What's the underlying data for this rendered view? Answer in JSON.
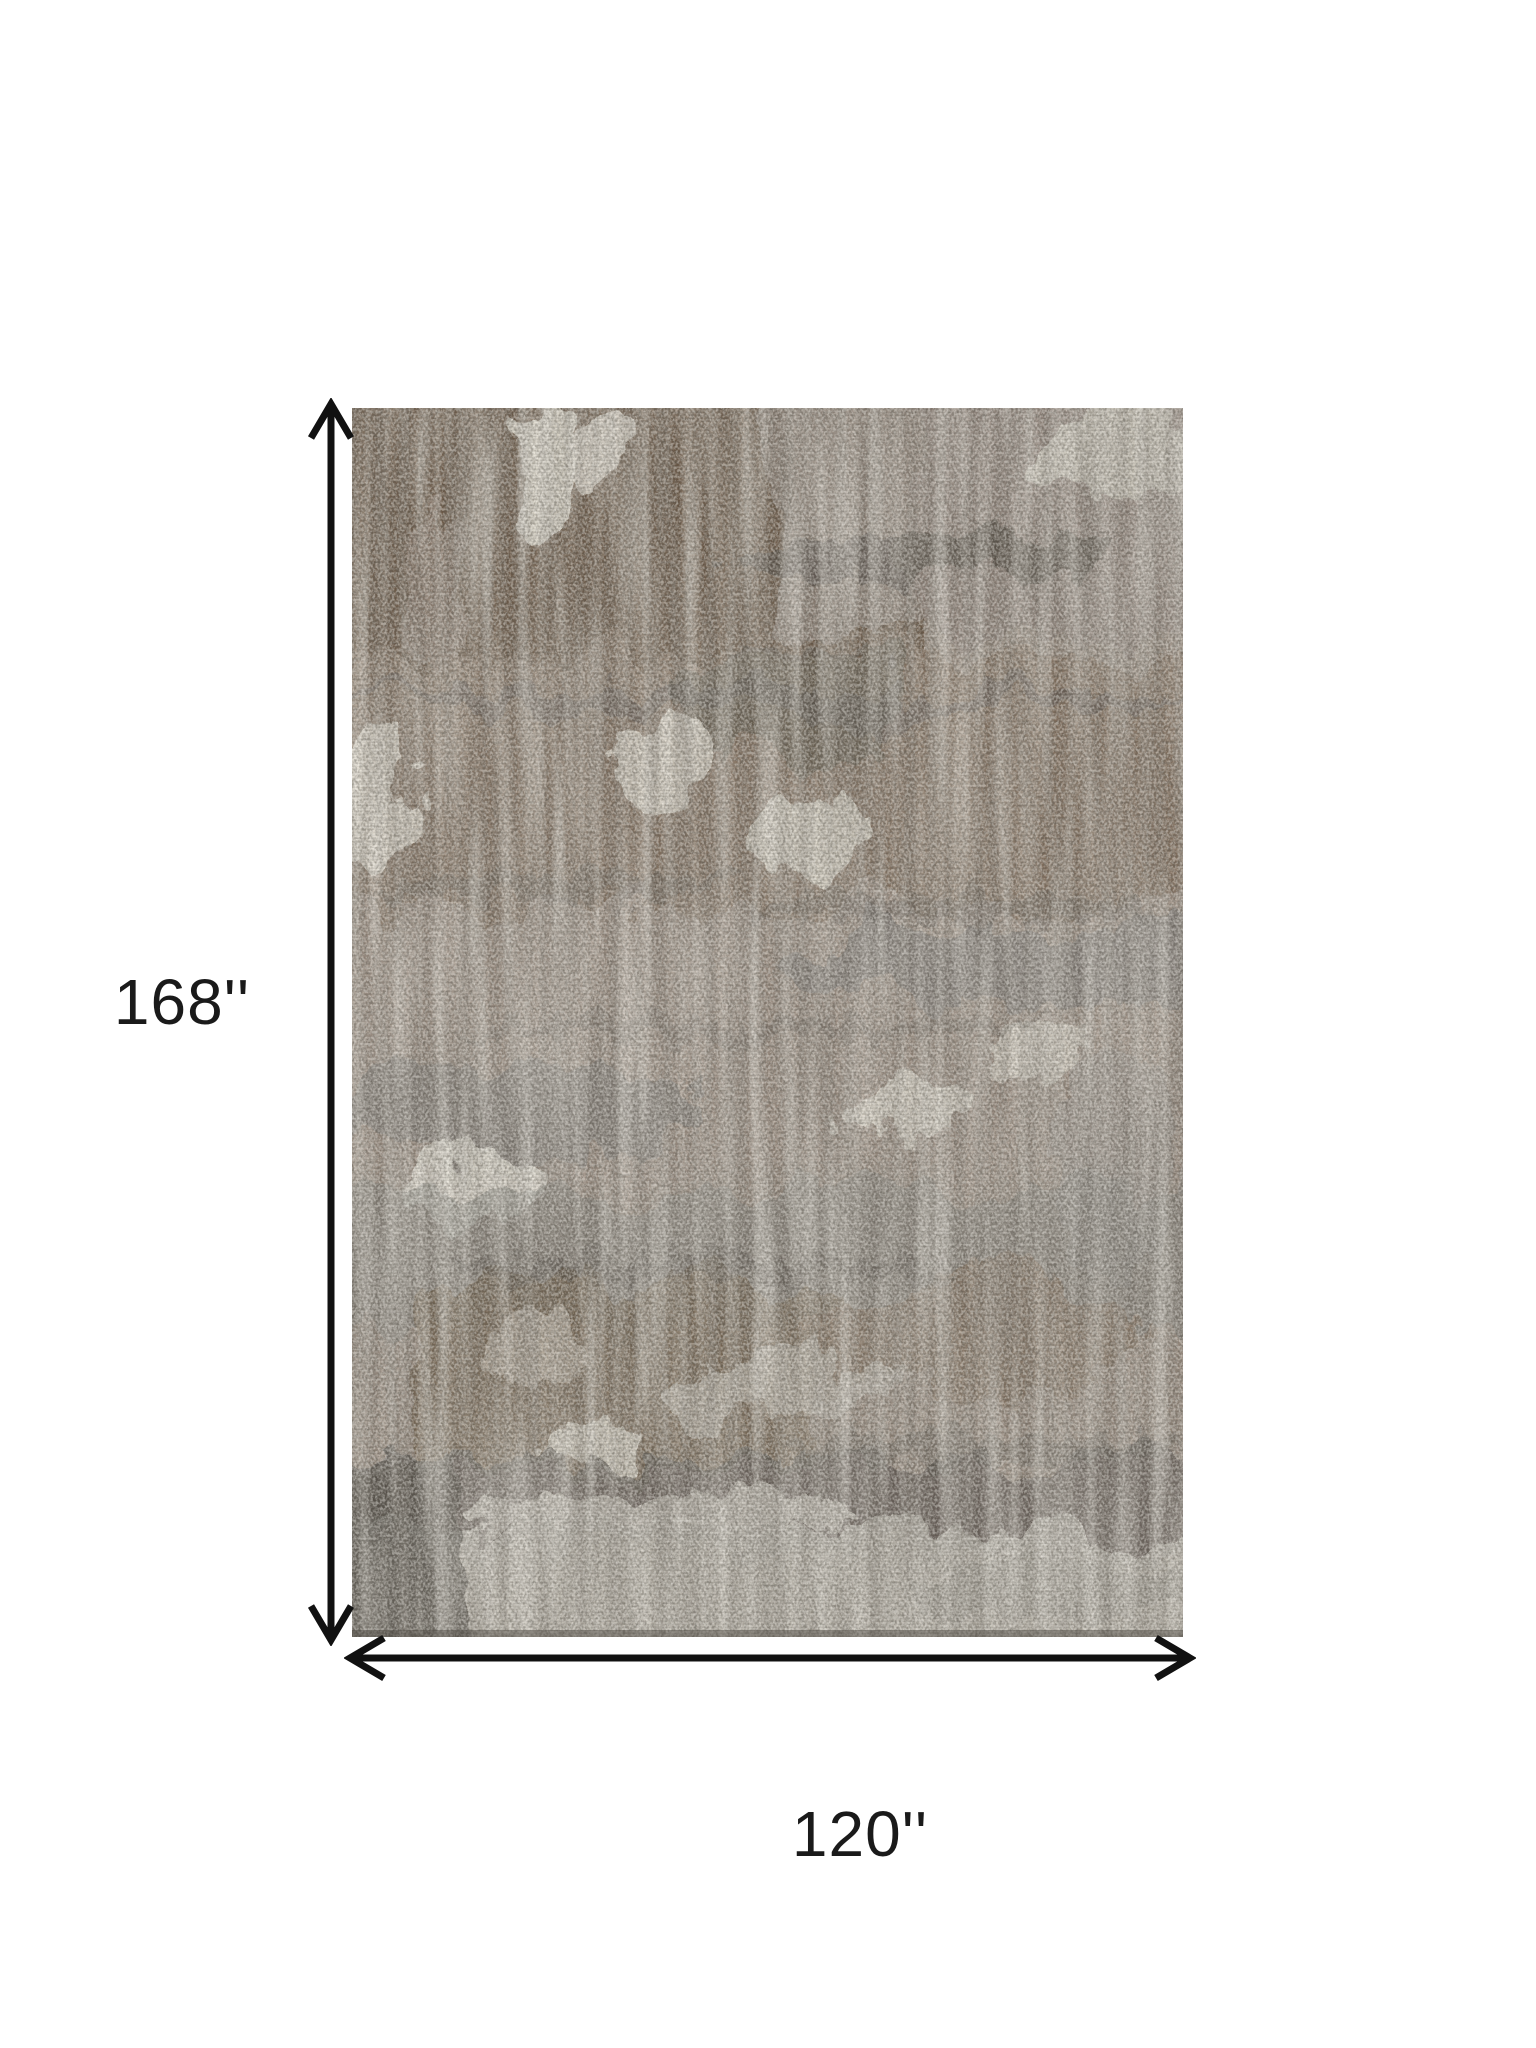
{
  "page": {
    "background_color": "#ffffff"
  },
  "dimensions": {
    "height_label": "168''",
    "width_label": "120''",
    "arrow_color": "#111111",
    "label_color": "#1a1a1a"
  },
  "rug": {
    "style": "distressed-abstract",
    "palette": {
      "base_taupe": "#95887c",
      "brown": "#64513e",
      "mid_brown": "#7c6a57",
      "gray": "#6f6f6d",
      "charcoal": "#4e4a44",
      "cream": "#e8e4d9",
      "light_band": "#b6b2a9"
    }
  }
}
